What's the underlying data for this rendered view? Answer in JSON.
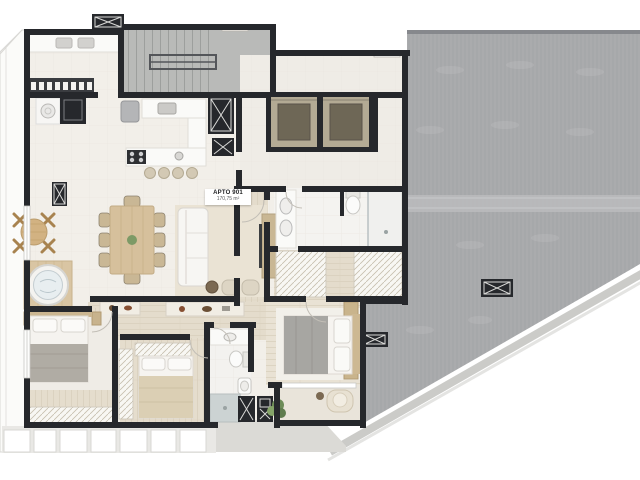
{
  "meta": {
    "type": "architectural-floor-plan",
    "description": "Top-view 3D render of an apartment floor plan with surrounding rooftop area"
  },
  "unit_label": {
    "title": "APTO 901",
    "area": "170,75 m²"
  },
  "colors": {
    "background": "#ffffff",
    "wall": "#26282c",
    "floor": "#f2efe9",
    "wood": "#e4dccc",
    "roof": "#aaabad",
    "roof_stripe": "#9d9ea0",
    "stair": "#b9bab8",
    "elevator_frame": "#b3aa94",
    "elevator_cab": "#6e6756",
    "rug": "#eae3d4",
    "wood_furniture": "#d6c09c",
    "blanket_gray": "#b0aca4",
    "blanket_beige": "#dbcfb4",
    "plant": "#7d9a66",
    "water": "#e8eef0",
    "terrace": "#dbdad6",
    "balcony_panel": "#ffffff",
    "label_bg": "#ffffff",
    "label_text": "#1d1e20"
  }
}
